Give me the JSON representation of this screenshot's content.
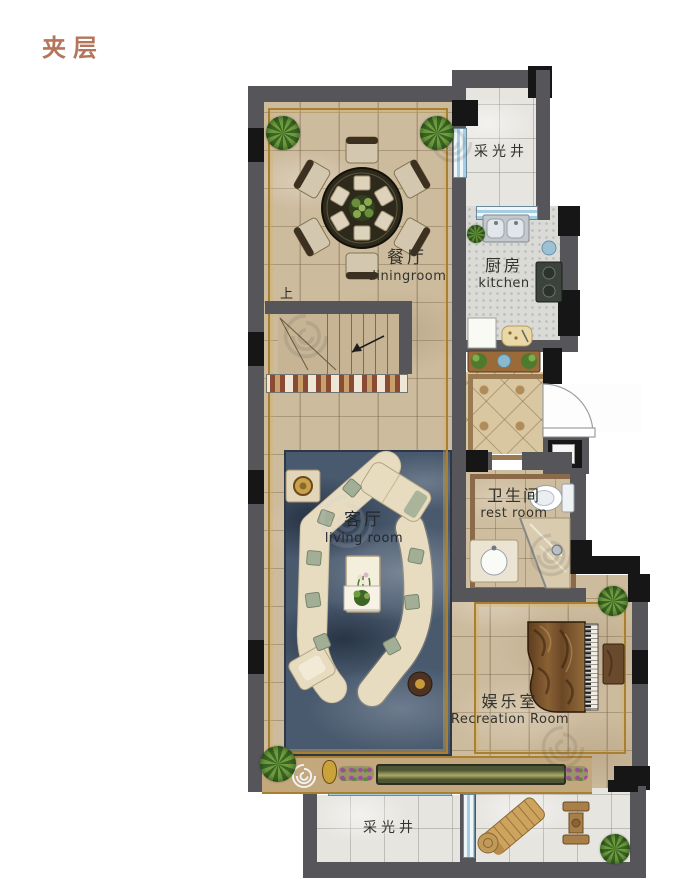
{
  "title": {
    "text": "夹层"
  },
  "rooms": {
    "dining": {
      "zh": "餐厅",
      "en": "diningroom"
    },
    "kitchen": {
      "zh": "厨房",
      "en": "kitchen"
    },
    "bathroom": {
      "zh": "卫生间",
      "en": "rest room"
    },
    "living": {
      "zh": "客厅",
      "en": "living room"
    },
    "recreation": {
      "zh": "娱乐室",
      "en": "Recreation Room"
    },
    "lightwell_top": {
      "zh": "采光井"
    },
    "lightwell_bottom": {
      "zh": "采光井"
    }
  },
  "labels": {
    "stairs_up": "上"
  },
  "furniture": [
    "dining-table",
    "dining-chairs",
    "sectional-sofa",
    "coffee-table",
    "grand-piano",
    "piano-bench",
    "toilet",
    "bathroom-sink",
    "shower",
    "kitchen-sink",
    "stove",
    "console-table",
    "lounge-chair",
    "patio-table",
    "stairs"
  ],
  "colors": {
    "title_brown": "#b5755a",
    "wall_gray": "#55555a",
    "wall_black": "#161616",
    "floor_beige": "#cdbb9e",
    "lightwell_gray": "#e7e5e0",
    "rug_blue": "#4a5a6e",
    "window_blue": "#a6cde2",
    "accent_gold": "#a8802f",
    "wood_brown": "#7b5a33",
    "plant_green": "#4e7a2e"
  }
}
